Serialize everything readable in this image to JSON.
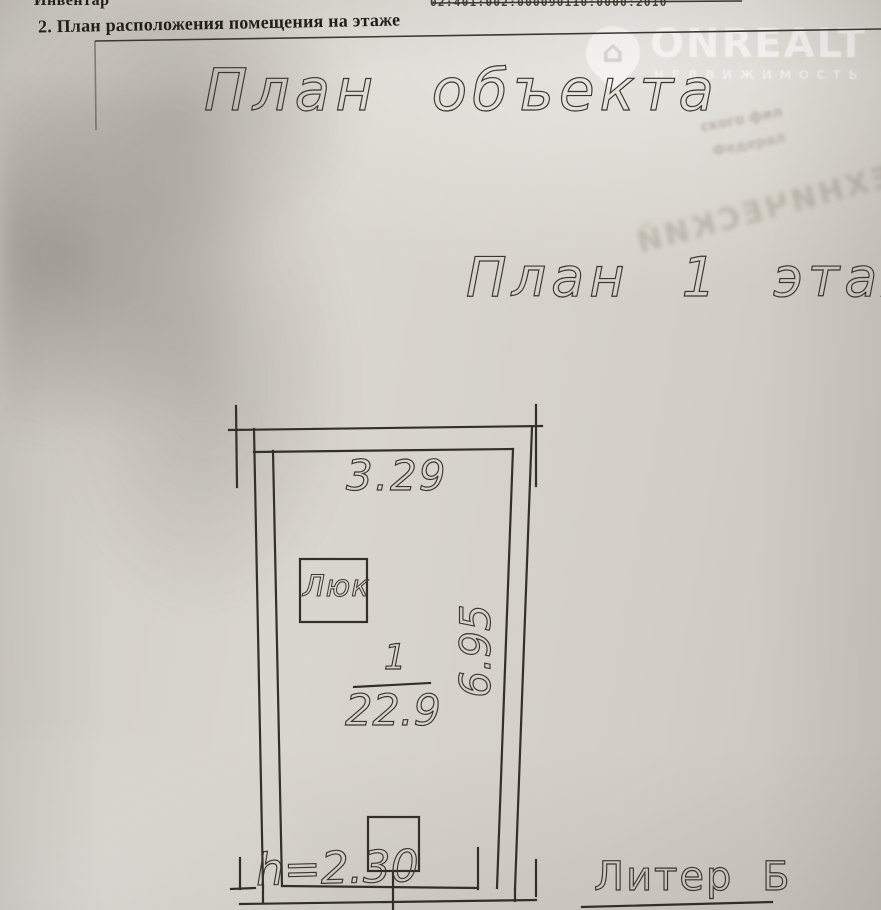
{
  "document": {
    "top_line": {
      "left_fragment": "Инвентар",
      "right_number": "02:401:002:000090110:0000:2010"
    },
    "heading": "2. План расположения помещения на этаже",
    "watermark": {
      "brand": "ONREALT",
      "tagline": "НЕДВИЖИМОСТЬ",
      "icon": "house-pin-icon",
      "house_glyph": "⌂"
    },
    "title": "План объекта",
    "floor_title": "План 1 этаж",
    "bleed_through": {
      "line1": "ского фил",
      "line2": "Федерал",
      "diagonal": "ТЕХНИЧЕСКИЙ"
    },
    "floor_plan": {
      "top_dimension": "3.29",
      "side_dimension": "6.95",
      "hatch_label": "Люк",
      "room_number": "1",
      "room_area": "22.9",
      "height_note": "h=2.30",
      "building_letter": "Литер Б"
    },
    "colors": {
      "ink": "#33302a",
      "paper": "#d5d1c9",
      "watermark": "#ffffff"
    }
  }
}
